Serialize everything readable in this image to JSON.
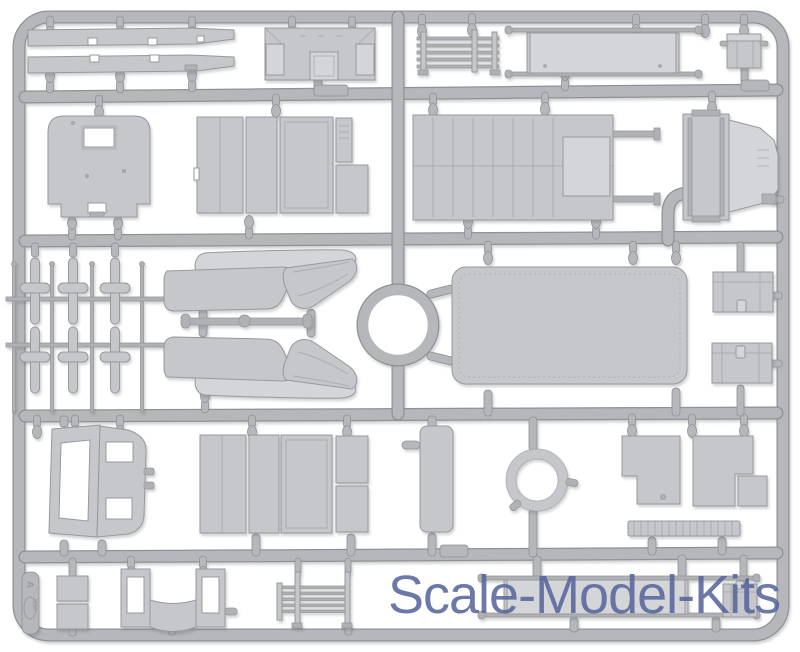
{
  "image_type": "product-photo",
  "subject": "Light-gray injection-molded plastic model kit sprue (frame A) with vehicle parts on white background",
  "watermark": {
    "text": "Scale-Model-Kits",
    "color": "#56659c"
  },
  "sprue_tag": {
    "brand": "ICM",
    "frame_letter": "A"
  },
  "colors": {
    "background": "#ffffff",
    "runner": "#b5b7ba",
    "runner_edge": "#8f9295",
    "part": "#c5c7ca",
    "part_light": "#d3d5d8",
    "part_dark": "#afb1b4",
    "part_edge": "#97999c",
    "watermark": "#56659c"
  },
  "parts": [
    {
      "id": "running-board-1",
      "label": "running board strip"
    },
    {
      "id": "running-board-2",
      "label": "running board strip"
    },
    {
      "id": "bulkhead-panel",
      "label": "cab bulkhead panel"
    },
    {
      "id": "roof-rack-1",
      "label": "slatted rack"
    },
    {
      "id": "stretcher-1",
      "label": "stretcher"
    },
    {
      "id": "stowage-box",
      "label": "stowage box"
    },
    {
      "id": "rear-wall-panel",
      "label": "body rear wall with window"
    },
    {
      "id": "door-panel-group-1",
      "label": "body side door panels"
    },
    {
      "id": "cargo-floor",
      "label": "cargo floor panel"
    },
    {
      "id": "engine-hood",
      "label": "engine hood assembly"
    },
    {
      "id": "axle-frame",
      "label": "axle rods and spring hangers"
    },
    {
      "id": "tie-rod",
      "label": "tie rod"
    },
    {
      "id": "bench-seat-1",
      "label": "bench seat half"
    },
    {
      "id": "bench-seat-2",
      "label": "bench seat half"
    },
    {
      "id": "roof-panel",
      "label": "roof panel"
    },
    {
      "id": "storage-chest-1",
      "label": "storage chest"
    },
    {
      "id": "storage-chest-2",
      "label": "storage chest"
    },
    {
      "id": "storage-chest-3",
      "label": "storage chest"
    },
    {
      "id": "windshield-assembly",
      "label": "windshield frame and cowl"
    },
    {
      "id": "door-panel-group-2",
      "label": "body side door panels"
    },
    {
      "id": "side-plank",
      "label": "side plank"
    },
    {
      "id": "tire-ring",
      "label": "tire ring"
    },
    {
      "id": "fender-plate-1",
      "label": "fender plate"
    },
    {
      "id": "fender-plate-2",
      "label": "fender plate"
    },
    {
      "id": "fender-square",
      "label": "small plate"
    },
    {
      "id": "tread-strip",
      "label": "treaded step strip"
    },
    {
      "id": "small-hatch-1",
      "label": "small hatch"
    },
    {
      "id": "small-hatch-2",
      "label": "small hatch"
    },
    {
      "id": "window-door-frame",
      "label": "door window frame"
    },
    {
      "id": "roof-rack-2",
      "label": "slatted rack"
    },
    {
      "id": "stretcher-2",
      "label": "stretcher"
    },
    {
      "id": "sprue-tag",
      "label": "ICM frame tag A"
    }
  ]
}
